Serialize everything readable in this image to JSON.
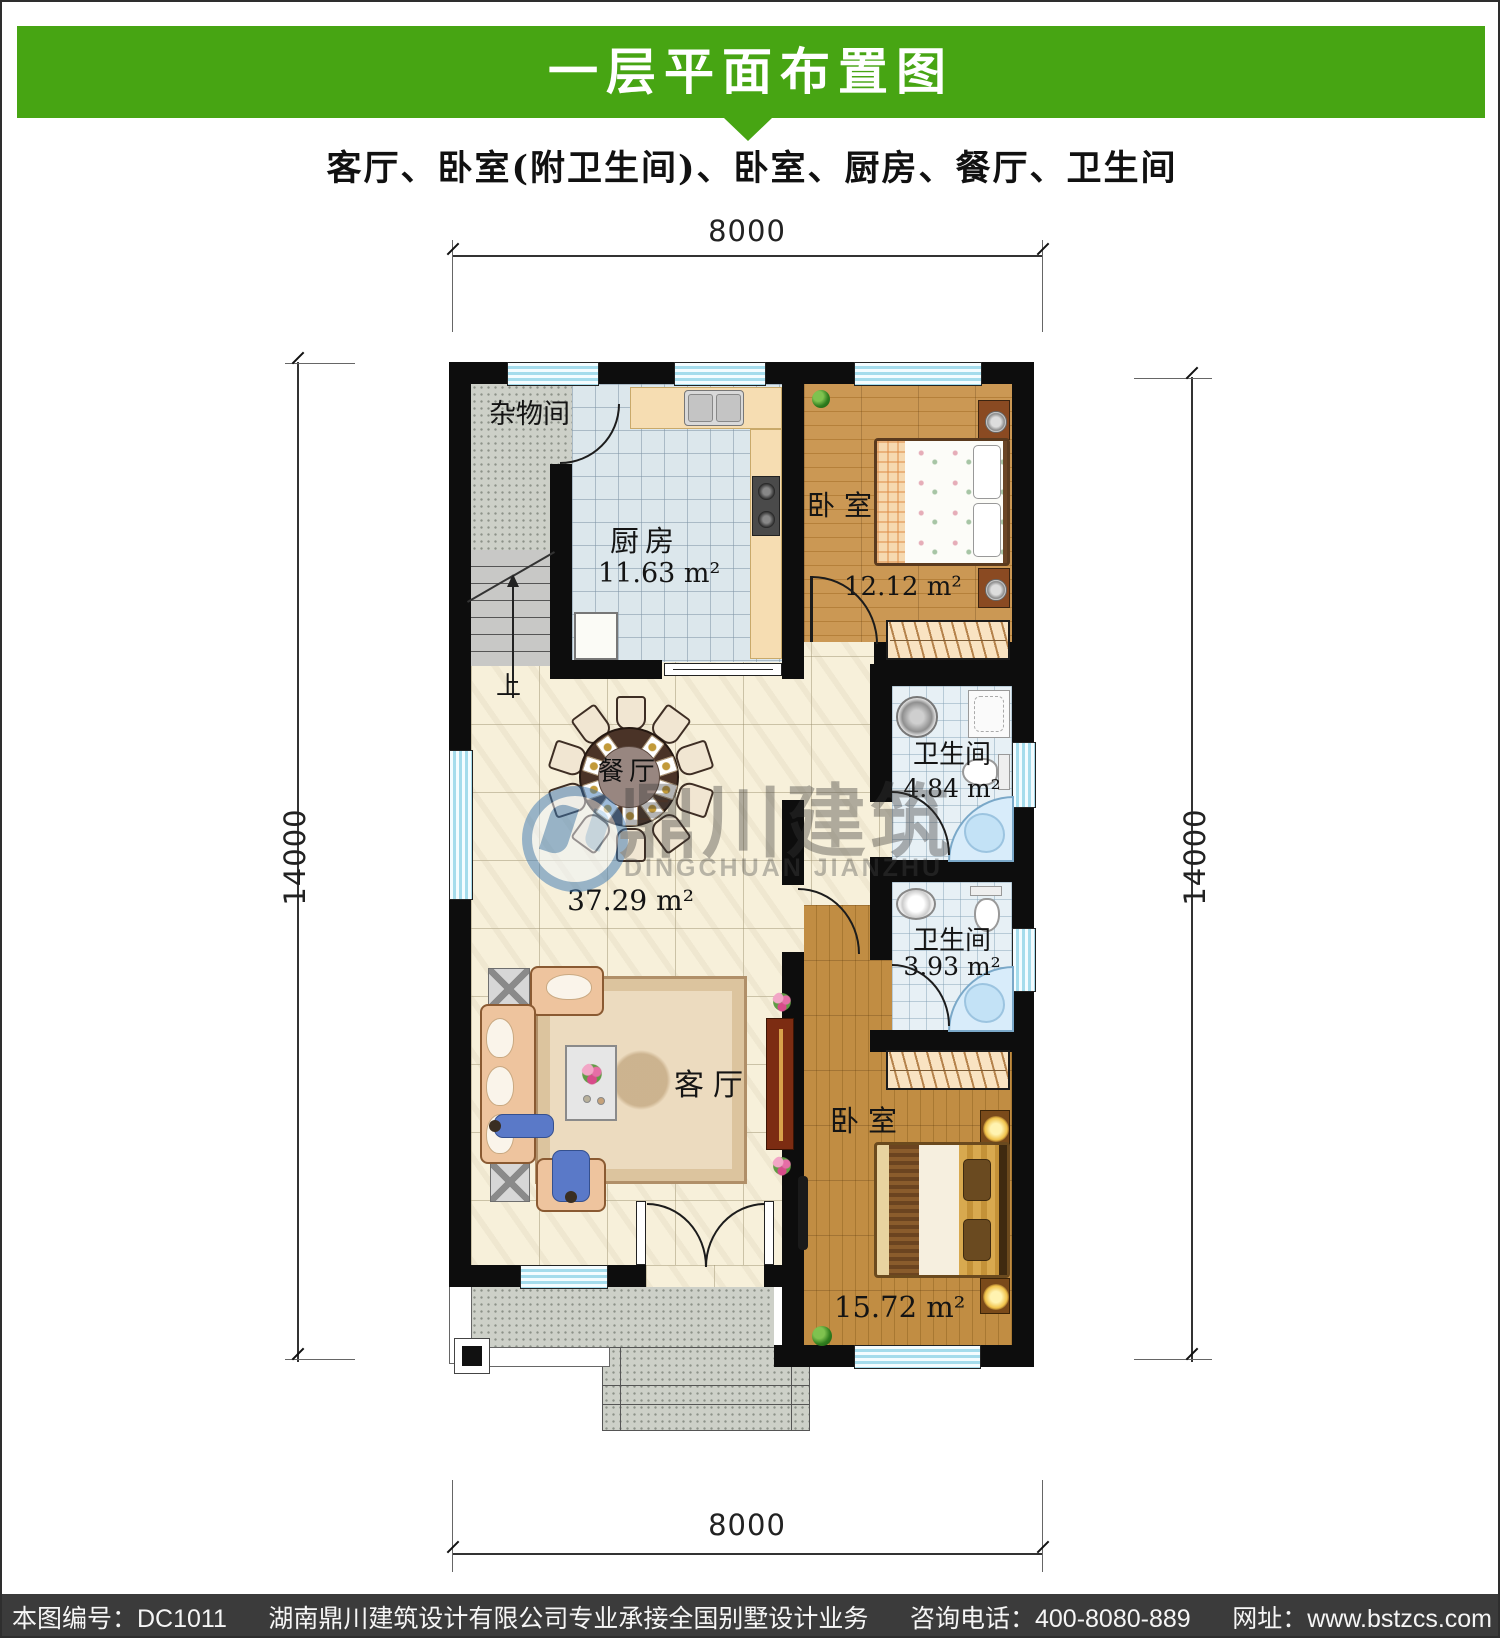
{
  "header": {
    "title": "一层平面布置图",
    "subtitle": "客厅、卧室(附卫生间)、卧室、厨房、餐厅、卫生间"
  },
  "dimensions": {
    "top": "8000",
    "bottom": "8000",
    "left": "14000",
    "right": "14000"
  },
  "rooms": {
    "storage": {
      "label": "杂物间"
    },
    "kitchen": {
      "label": "厨房",
      "area": "11.63 m²"
    },
    "bedroom_top": {
      "label": "卧室",
      "area": "12.12 m²"
    },
    "bath_top": {
      "label": "卫生间",
      "area": "4.84 m²"
    },
    "bath_bottom": {
      "label": "卫生间",
      "area": "3.93 m²"
    },
    "dining": {
      "label": "餐厅",
      "area": "37.29 m²"
    },
    "living": {
      "label": "客厅"
    },
    "bedroom_bottom": {
      "label": "卧室",
      "area": "15.72 m²"
    },
    "stairs": {
      "up_label": "上"
    }
  },
  "watermark": {
    "name_cn": "鼎川建筑",
    "name_en": "DINGCHUAN JIANZHU"
  },
  "footer": {
    "drawing_no": "本图编号：DC1011",
    "company": "湖南鼎川建筑设计有限公司专业承接全国别墅设计业务",
    "phone": "咨询电话：400-8080-889",
    "website": "网址：www.bstzcs.com"
  },
  "colors": {
    "banner_green": "#47a513",
    "footer_gray": "#3b3b3b",
    "wall_black": "#0d0d0d",
    "window_blue": "#a5dcec",
    "floor_cream": "#f7f0da",
    "wood": "#c18d43",
    "bath_tile": "#e7f0f5",
    "tub_blue": "#d8ecfa",
    "counter_wheat": "#f6ddb2"
  }
}
